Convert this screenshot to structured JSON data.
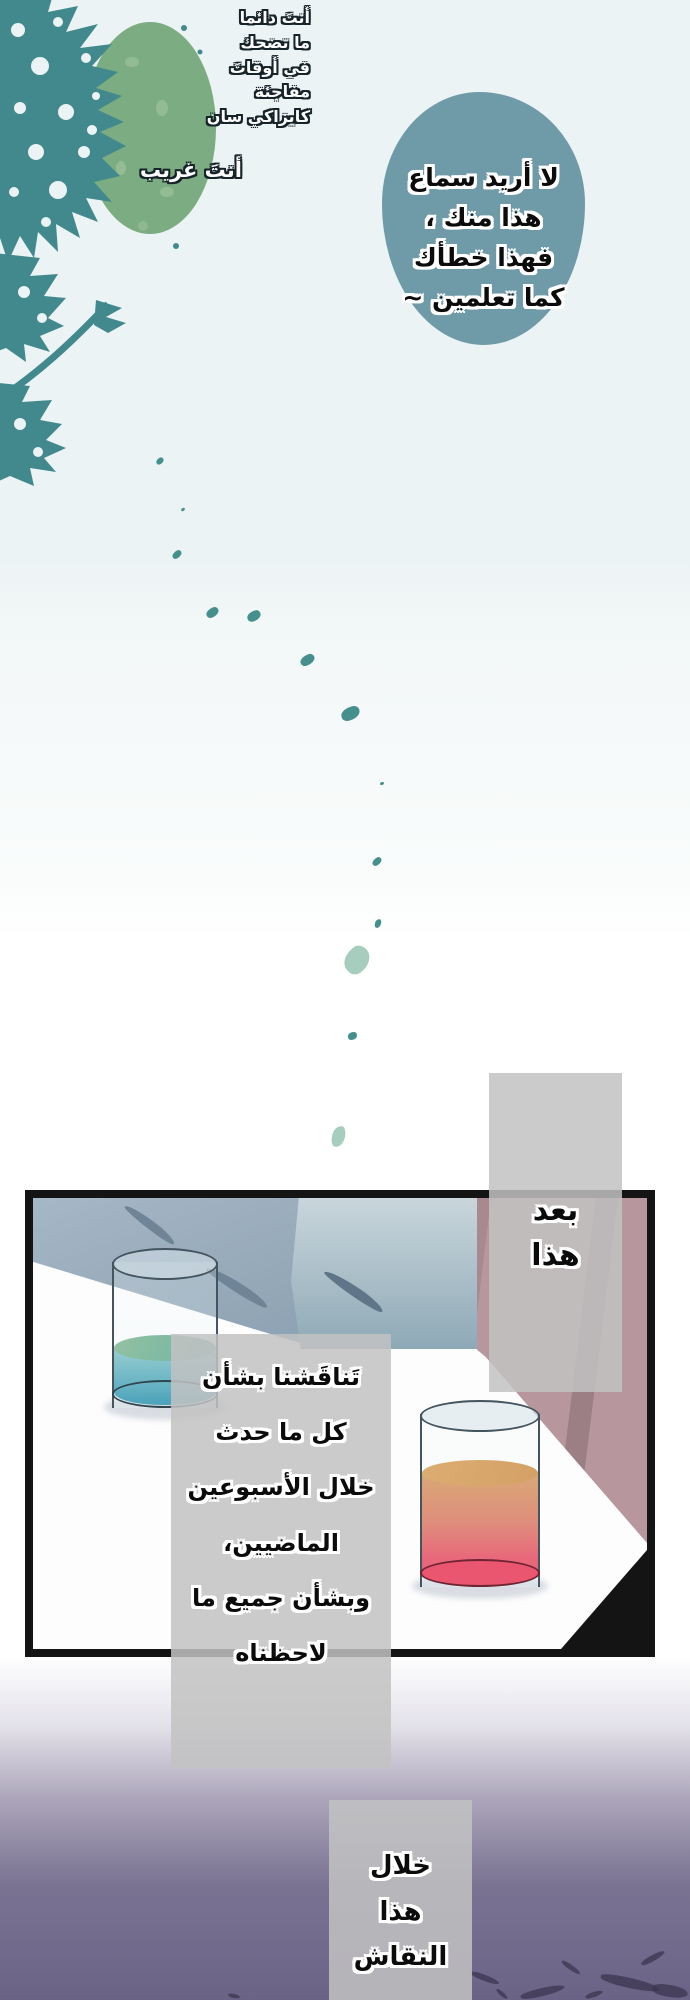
{
  "captions": {
    "top_left": {
      "lines": [
        "أنتَ دائما",
        "ما تضحك",
        "في أوقاتَ",
        "مفاجئة",
        "كايزاكي سان"
      ]
    },
    "you_are_strange": "أنتَ غريب",
    "after_this": {
      "lines": [
        "بعد",
        "هذا"
      ]
    },
    "discussion": {
      "lines": [
        "تَناقَشنا بشأن",
        "كل ما حدث",
        "خلال الأسبوعين",
        "الماضيين،",
        "وبشأن جميع ما",
        "لاحظناه"
      ]
    },
    "during_discussion": {
      "lines": [
        "خلال",
        "هذا",
        "النقاش"
      ]
    }
  },
  "speech_bubble": {
    "lines": [
      "لا أريد سماع",
      "هذا منك ،",
      "فهذا خطأك",
      "كما تعلمين ~"
    ]
  },
  "colors": {
    "background_top": "#ECF3F4",
    "background_bottom": "#6B6386",
    "tree_teal": "#42898E",
    "foliage_green": "#7CAC81",
    "speech_bubble_fill": "#6F9AA8",
    "caption_box_gray": "#C2C2C2",
    "panel_border": "#141414",
    "left_glass_liquid": "#3E9DB6",
    "left_glass_surface": "#8FBF9D",
    "right_glass_liquid": "#EA5570",
    "right_glass_surface": "#D9A974",
    "leaf_teal": "#45908C",
    "leaf_light_green": "#A6CDBE"
  }
}
